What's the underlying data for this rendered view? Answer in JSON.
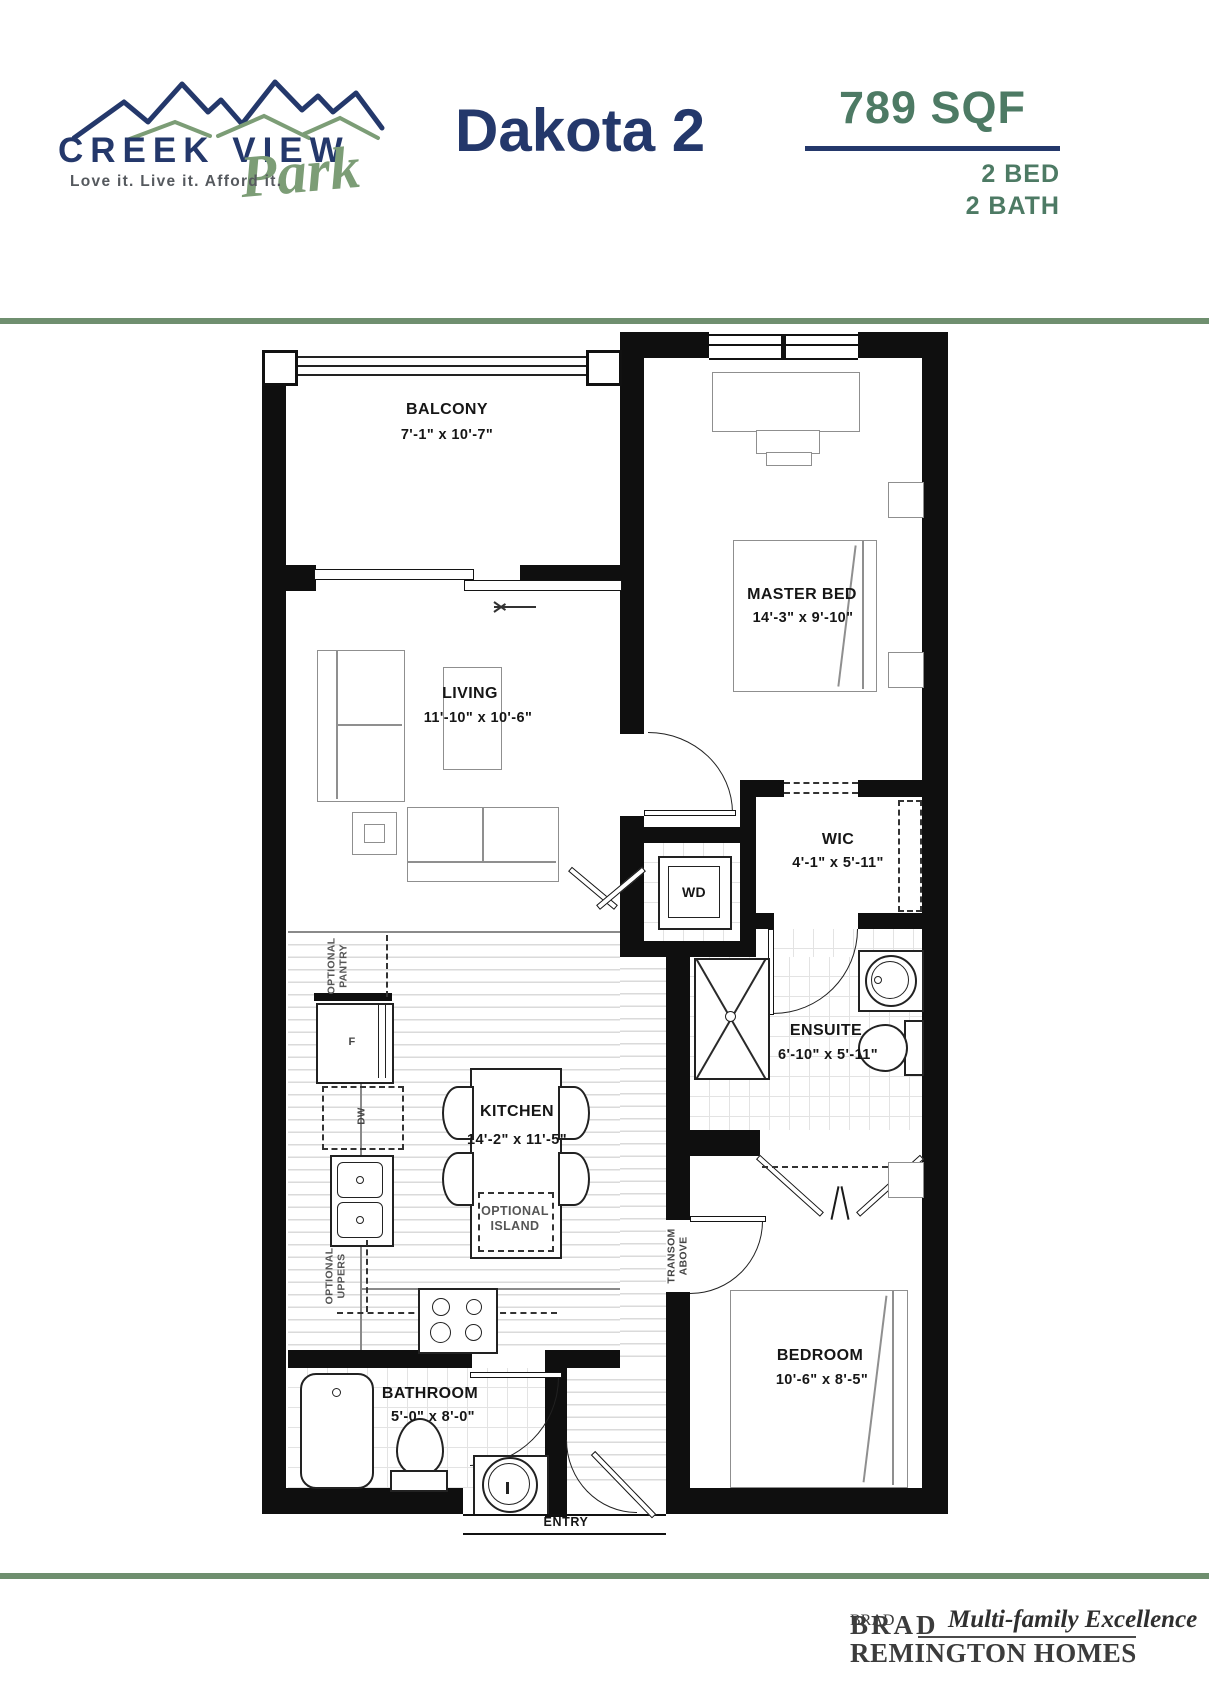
{
  "header": {
    "brand_line1": "CREEK VIEW",
    "brand_script": "Park",
    "tagline": "Love it. Live it. Afford it.",
    "plan_name": "Dakota 2",
    "area": "789 SQF",
    "bed": "2 BED",
    "bath": "2 BATH"
  },
  "colors": {
    "navy": "#24386b",
    "green": "#4d7a64",
    "line-green": "#6f8f6f",
    "logo-green": "#7c9d76"
  },
  "plan": {
    "rooms": [
      {
        "name": "BALCONY",
        "dims": "7'-1\" x 10'-7\""
      },
      {
        "name": "MASTER BED",
        "dims": "14'-3\" x 9'-10\""
      },
      {
        "name": "LIVING",
        "dims": "11'-10\" x 10'-6\""
      },
      {
        "name": "WIC",
        "dims": "4'-1\" x 5'-11\""
      },
      {
        "name": "ENSUITE",
        "dims": "6'-10\" x 5'-11\""
      },
      {
        "name": "KITCHEN",
        "dims": "14'-2\" x 11'-5\""
      },
      {
        "name": "BEDROOM",
        "dims": "10'-6\" x 8'-5\""
      },
      {
        "name": "BATHROOM",
        "dims": "5'-0\" x 8'-0\""
      }
    ],
    "labels": {
      "wd": "WD",
      "fridge": "F",
      "dw": "DW",
      "entry": "ENTRY",
      "island_1": "OPTIONAL",
      "island_2": "ISLAND",
      "pantry_1": "OPTIONAL",
      "pantry_2": "PANTRY",
      "uppers_1": "OPTIONAL",
      "uppers_2": "UPPERS",
      "transom_1": "TRANSOM",
      "transom_2": "ABOVE"
    }
  },
  "footer": {
    "brand_top": "BRAD",
    "brand_script": "Multi-family Excellence",
    "brand_bottom": "REMINGTON HOMES"
  }
}
